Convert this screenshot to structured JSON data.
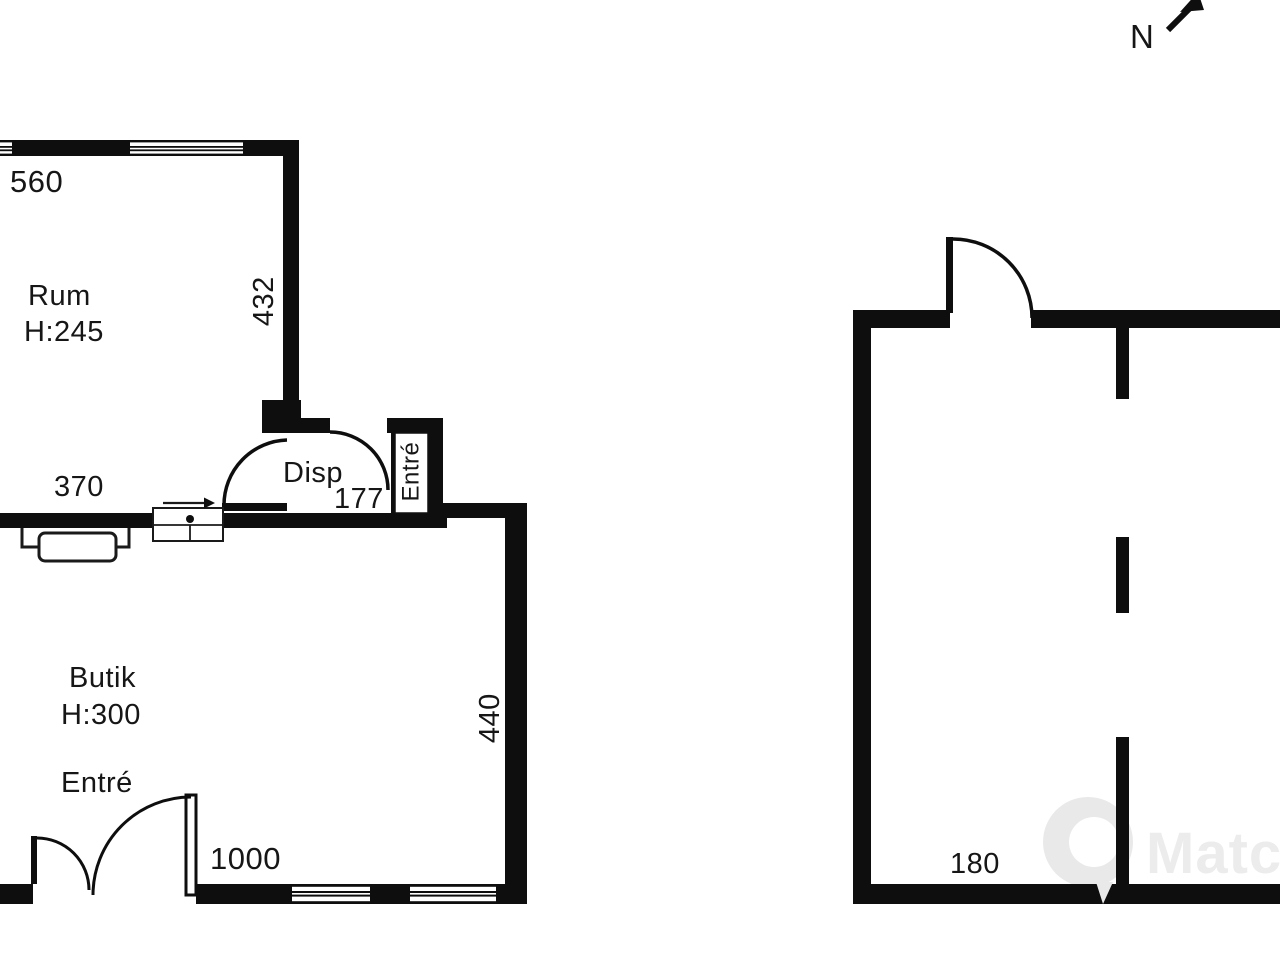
{
  "colors": {
    "wall_ink": "#0e0e0e",
    "label_ink": "#161616",
    "watermark_gray": "#ececec",
    "background": "#ffffff"
  },
  "compass": {
    "label": "N"
  },
  "watermark": {
    "brand_text": "Match"
  },
  "buildings": {
    "left": {
      "rooms": {
        "rum": {
          "name": "Rum",
          "ceiling_height": "H:245"
        },
        "butik": {
          "name": "Butik",
          "ceiling_height": "H:300"
        },
        "disp": {
          "name": "Disp"
        }
      },
      "entrances": {
        "vestibule_label": "Entré",
        "shop_door_label": "Entré"
      },
      "dimensions": {
        "rum_top_width": "560",
        "rum_right_depth": "432",
        "interior_wall_width": "370",
        "disp_width": "177",
        "butik_right_depth": "440",
        "butik_bottom_width": "1000"
      }
    },
    "right": {
      "dimensions": {
        "bottom_width": "180"
      }
    }
  }
}
